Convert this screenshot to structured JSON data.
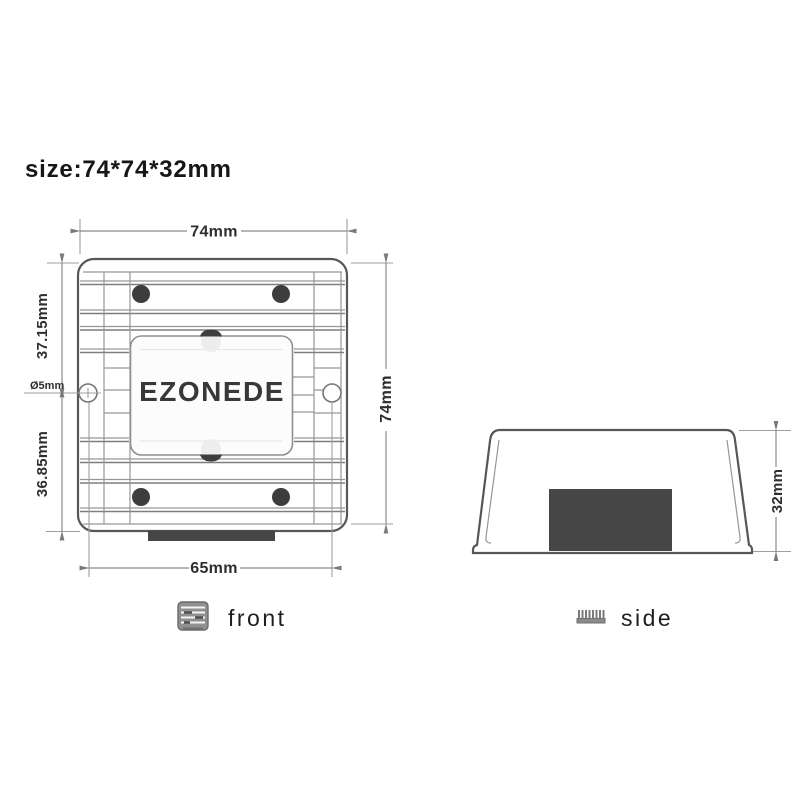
{
  "title": "size:74*74*32mm",
  "brand": "EZONEDE",
  "front": {
    "label": "front",
    "dim_top": "74mm",
    "dim_right": "74mm",
    "dim_left_upper": "37.15mm",
    "dim_left_lower": "36.85mm",
    "dim_bottom": "65mm",
    "dim_hole": "Ø5mm"
  },
  "side": {
    "label": "side",
    "dim_height": "32mm"
  },
  "colors": {
    "background": "#ffffff",
    "outline": "#575757",
    "fin_line": "#969696",
    "dimension_line": "#8a8a8a",
    "dimension_text": "#2e2e2e",
    "screw_dark": "#3d3d3d",
    "connector_block": "#464646",
    "brand_text": "#383838"
  }
}
